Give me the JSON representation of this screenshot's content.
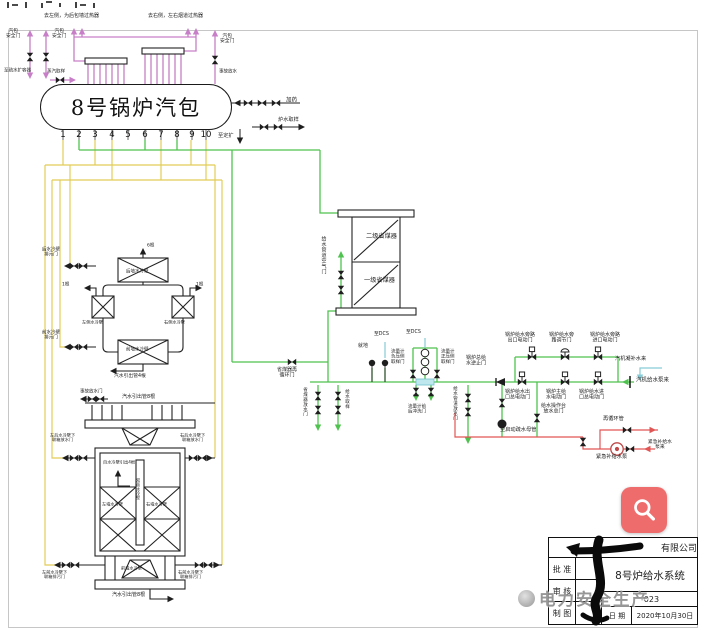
{
  "palette": {
    "steam_pipe_pink": "#c77fc7",
    "feedwater_green": "#4fc24f",
    "blowdown_yellow": "#e2cd58",
    "emergency_red": "#e25555",
    "instrument_cyan": "#86ccd6",
    "equipment_black": "#222222",
    "magnifier_red": "#ee6c6c",
    "watermark_gray": "#8f8f8f"
  },
  "drum": {
    "title": "8号锅炉汽包",
    "nozzles": [
      "1",
      "2",
      "3",
      "4",
      "5",
      "6",
      "7",
      "8",
      "9",
      "10"
    ]
  },
  "labels": [
    {
      "t": "去左侧，为后包墙过热器",
      "x": 44,
      "y": 13,
      "fs": 5
    },
    {
      "t": "去右侧，左右烟道过热器",
      "x": 148,
      "y": 13,
      "fs": 5
    },
    {
      "t": "汽包\n安全门",
      "x": 6,
      "y": 28,
      "fs": 4.8
    },
    {
      "t": "汽包\n安全门",
      "x": 52,
      "y": 28,
      "fs": 4.8
    },
    {
      "t": "至疏水扩容器",
      "x": 4,
      "y": 68,
      "fs": 4.5
    },
    {
      "t": "蒸汽取样",
      "x": 47,
      "y": 69,
      "fs": 4.5
    },
    {
      "t": "汽包\n安全门",
      "x": 220,
      "y": 33,
      "fs": 4.8
    },
    {
      "t": "事故放水",
      "x": 219,
      "y": 69,
      "fs": 4.5
    },
    {
      "t": "加药",
      "x": 286,
      "y": 97,
      "fs": 5.5
    },
    {
      "t": "炉水取样",
      "x": 278,
      "y": 117,
      "fs": 5.2
    },
    {
      "t": "至定扩",
      "x": 218,
      "y": 133,
      "fs": 5.2
    },
    {
      "t": "给水管道空气门",
      "x": 320,
      "y": 236,
      "fs": 5,
      "vert": true
    },
    {
      "t": "二级省煤器",
      "x": 366,
      "y": 233,
      "fs": 6.2
    },
    {
      "t": "一级省煤器",
      "x": 364,
      "y": 277,
      "fs": 6.2
    },
    {
      "t": "省煤器再\n循环门",
      "x": 277,
      "y": 367,
      "fs": 5
    },
    {
      "t": "省煤器放水门",
      "x": 302,
      "y": 387,
      "fs": 4.5,
      "vert": true
    },
    {
      "t": "给水取样",
      "x": 344,
      "y": 389,
      "fs": 4.5,
      "vert": true
    },
    {
      "t": "就地",
      "x": 358,
      "y": 343,
      "fs": 5
    },
    {
      "t": "至DCS",
      "x": 374,
      "y": 331,
      "fs": 4.8
    },
    {
      "t": "至DCS",
      "x": 406,
      "y": 329,
      "fs": 4.8
    },
    {
      "t": "流量计\n负压侧\n取样门",
      "x": 391,
      "y": 349,
      "fs": 4.5
    },
    {
      "t": "流量计\n正压侧\n取样门",
      "x": 441,
      "y": 349,
      "fs": 4.5
    },
    {
      "t": "流量计前\n后冲洗门",
      "x": 408,
      "y": 404,
      "fs": 4.5
    },
    {
      "t": "给水管道放水门",
      "x": 452,
      "y": 386,
      "fs": 4.5,
      "vert": true
    },
    {
      "t": "锅炉总给\n水逆止门",
      "x": 466,
      "y": 355,
      "fs": 5
    },
    {
      "t": "锅炉给水出\n口总电动门",
      "x": 505,
      "y": 389,
      "fs": 5
    },
    {
      "t": "锅炉主给\n水电动门",
      "x": 546,
      "y": 389,
      "fs": 5
    },
    {
      "t": "锅炉给水进\n口总电动门",
      "x": 579,
      "y": 389,
      "fs": 5
    },
    {
      "t": "给水操作台\n放水总门",
      "x": 541,
      "y": 403,
      "fs": 5
    },
    {
      "t": "锅炉给水旁路\n出口电动门",
      "x": 505,
      "y": 332,
      "fs": 5
    },
    {
      "t": "锅炉给水旁\n路调节门",
      "x": 549,
      "y": 332,
      "fs": 5
    },
    {
      "t": "锅炉给水旁路\n进口电动门",
      "x": 590,
      "y": 332,
      "fs": 5
    },
    {
      "t": "汽机凝补水来",
      "x": 615,
      "y": 356,
      "fs": 5.2
    },
    {
      "t": "汽机给水泵来",
      "x": 636,
      "y": 377,
      "fs": 5.5
    },
    {
      "t": "至启动疏水母管",
      "x": 500,
      "y": 427,
      "fs": 5.2
    },
    {
      "t": "再循环管",
      "x": 603,
      "y": 416,
      "fs": 5.2
    },
    {
      "t": "紧急补给水泵",
      "x": 596,
      "y": 454,
      "fs": 5.2
    },
    {
      "t": "紧急补给水泵来",
      "x": 646,
      "y": 439,
      "fs": 4.8
    },
    {
      "t": "后水冷壁\n排污门",
      "x": 42,
      "y": 247,
      "fs": 4.5
    },
    {
      "t": "前水冷壁\n排污门",
      "x": 42,
      "y": 330,
      "fs": 4.5
    },
    {
      "t": "后墙水冷壁",
      "x": 126,
      "y": 269,
      "fs": 4.5
    },
    {
      "t": "前墙水冷壁",
      "x": 126,
      "y": 347,
      "fs": 4.5
    },
    {
      "t": "左侧水冷壁",
      "x": 82,
      "y": 320,
      "fs": 4.2
    },
    {
      "t": "右侧水冷壁",
      "x": 164,
      "y": 320,
      "fs": 4.2
    },
    {
      "t": "6根",
      "x": 147,
      "y": 243,
      "fs": 4.5
    },
    {
      "t": "1根",
      "x": 62,
      "y": 282,
      "fs": 4.5
    },
    {
      "t": "1根",
      "x": 196,
      "y": 282,
      "fs": 4.5
    },
    {
      "t": "汽水引出管4根",
      "x": 114,
      "y": 373,
      "fs": 4.8
    },
    {
      "t": "事故放水门",
      "x": 80,
      "y": 389,
      "fs": 4.5
    },
    {
      "t": "汽水引出管8根",
      "x": 122,
      "y": 394,
      "fs": 5
    },
    {
      "t": "左后水冷壁下\n联箱放水门",
      "x": 50,
      "y": 433,
      "fs": 4.2
    },
    {
      "t": "右后水冷壁下\n联箱放水门",
      "x": 180,
      "y": 433,
      "fs": 4.2
    },
    {
      "t": "自水冷壁引出4根",
      "x": 103,
      "y": 460,
      "fs": 4.2
    },
    {
      "t": "左墙水冷壁",
      "x": 102,
      "y": 502,
      "fs": 4.2
    },
    {
      "t": "右墙水冷壁",
      "x": 146,
      "y": 502,
      "fs": 4.2
    },
    {
      "t": "双面水冷壁",
      "x": 135,
      "y": 478,
      "fs": 4,
      "vert": true
    },
    {
      "t": "左前水冷壁下\n联箱排污门",
      "x": 42,
      "y": 570,
      "fs": 4.2
    },
    {
      "t": "右前水冷壁下\n联箱排污门",
      "x": 178,
      "y": 570,
      "fs": 4.2
    },
    {
      "t": "前墙水冷壁",
      "x": 121,
      "y": 566,
      "fs": 4.2
    },
    {
      "t": "汽水引出管8根",
      "x": 112,
      "y": 592,
      "fs": 5
    }
  ],
  "title_block": {
    "company": "有限公司",
    "approve_label": "批  准",
    "review_label": "审  核",
    "draft_label": "制  图",
    "drawing_title": "8号炉给水系统",
    "drawing_no": "-023",
    "date_label": "日 期",
    "date": "2020年10月30日"
  },
  "watermark": {
    "text": "电力安全生产"
  },
  "magnifier": {
    "tooltip": "放大查看"
  }
}
